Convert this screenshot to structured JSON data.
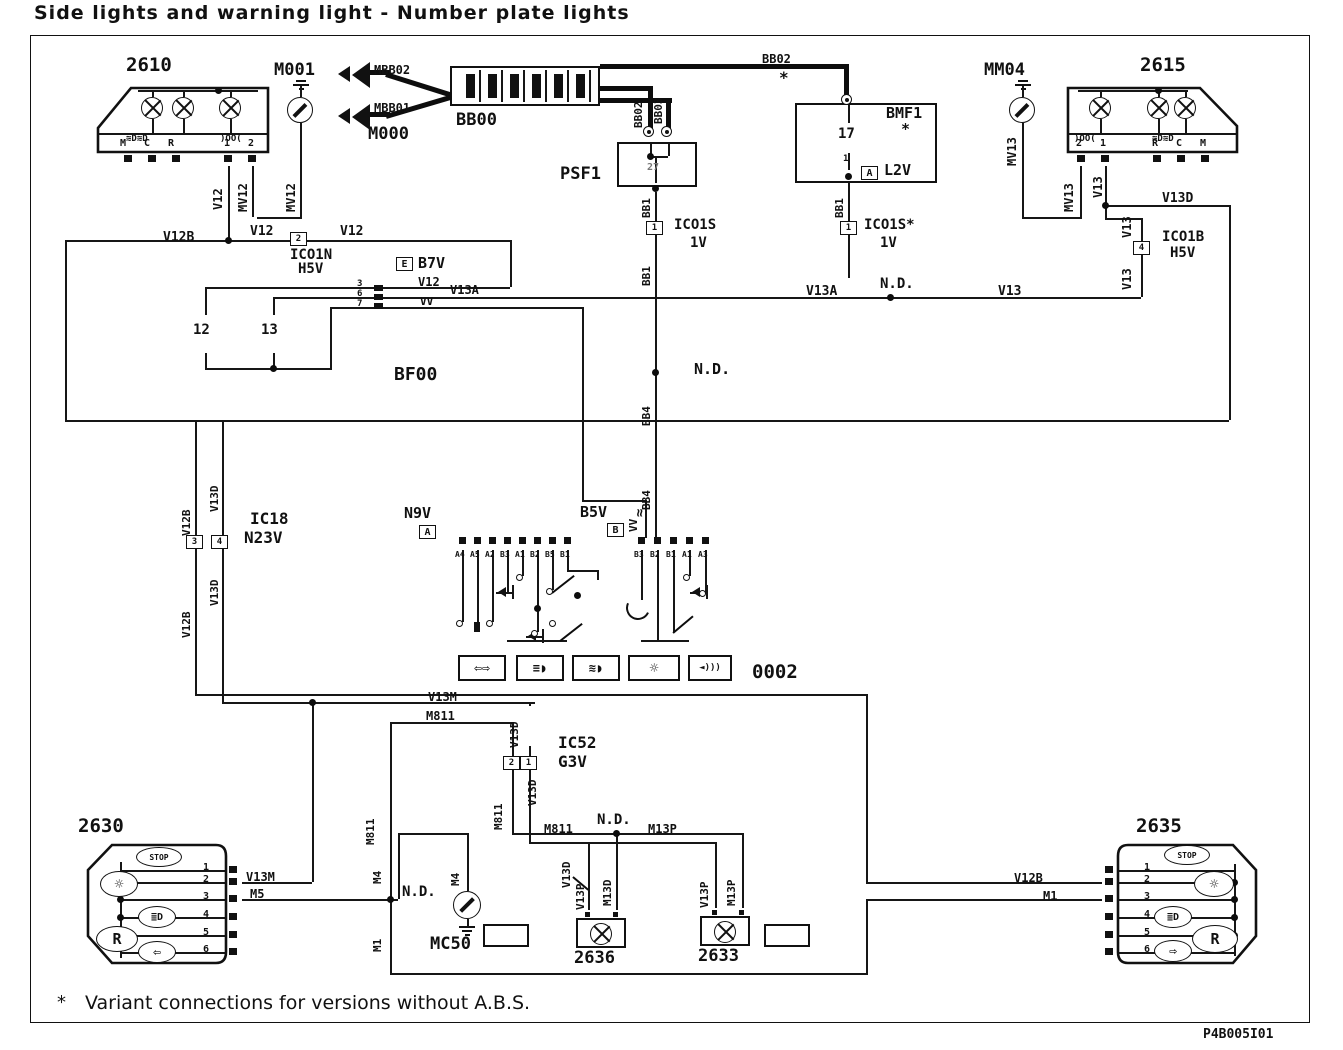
{
  "title": "Side lights and warning light - Number plate lights",
  "footnote": {
    "star": "*",
    "text": "Variant connections for versions without A.B.S."
  },
  "ref_code": "P4B005I01",
  "labels": [
    {
      "t": "2610",
      "x": 126,
      "y": 56,
      "s": 19,
      "n": "component-2610-label"
    },
    {
      "t": "M001",
      "x": 274,
      "y": 62,
      "s": 17,
      "n": "component-m001-label"
    },
    {
      "t": "MBB02",
      "x": 374,
      "y": 64,
      "s": 12,
      "n": "wire-label"
    },
    {
      "t": "MBB01",
      "x": 374,
      "y": 102,
      "s": 12,
      "n": "wire-label"
    },
    {
      "t": "M000",
      "x": 368,
      "y": 126,
      "s": 17,
      "n": "component-m000-label"
    },
    {
      "t": "BB00",
      "x": 456,
      "y": 112,
      "s": 17,
      "n": "component-bb00-label"
    },
    {
      "t": "PSF1",
      "x": 560,
      "y": 166,
      "s": 17,
      "n": "component-psf1-label"
    },
    {
      "t": "27",
      "x": 647,
      "y": 163,
      "s": 10,
      "n": "terminal-label",
      "c": "#777"
    },
    {
      "t": "BB02",
      "x": 762,
      "y": 53,
      "s": 12,
      "n": "wire-label"
    },
    {
      "t": "*",
      "x": 779,
      "y": 70,
      "s": 16,
      "n": "variant-star"
    },
    {
      "t": "BMF1",
      "x": 886,
      "y": 106,
      "s": 15,
      "n": "component-bmf1-label"
    },
    {
      "t": "*",
      "x": 901,
      "y": 122,
      "s": 15,
      "n": "variant-star"
    },
    {
      "t": "17",
      "x": 838,
      "y": 127,
      "s": 14,
      "n": "fuse-17-label"
    },
    {
      "t": "1",
      "x": 843,
      "y": 155,
      "s": 9,
      "n": "terminal-label"
    },
    {
      "t": "L2V",
      "x": 884,
      "y": 163,
      "s": 15,
      "n": "connector-l2v-label"
    },
    {
      "t": "MM04",
      "x": 984,
      "y": 62,
      "s": 17,
      "n": "component-mm04-label"
    },
    {
      "t": "2615",
      "x": 1140,
      "y": 56,
      "s": 19,
      "n": "component-2615-label"
    },
    {
      "t": "M",
      "x": 120,
      "y": 139,
      "s": 10,
      "n": "terminal-label"
    },
    {
      "t": "C",
      "x": 144,
      "y": 139,
      "s": 10,
      "n": "terminal-label"
    },
    {
      "t": "R",
      "x": 168,
      "y": 139,
      "s": 10,
      "n": "terminal-label"
    },
    {
      "t": "1",
      "x": 224,
      "y": 139,
      "s": 10,
      "n": "terminal-label"
    },
    {
      "t": "2",
      "x": 248,
      "y": 139,
      "s": 10,
      "n": "terminal-label"
    },
    {
      "t": "2",
      "x": 1076,
      "y": 139,
      "s": 10,
      "n": "terminal-label"
    },
    {
      "t": "1",
      "x": 1100,
      "y": 139,
      "s": 10,
      "n": "terminal-label"
    },
    {
      "t": "R",
      "x": 1152,
      "y": 139,
      "s": 10,
      "n": "terminal-label"
    },
    {
      "t": "C",
      "x": 1176,
      "y": 139,
      "s": 10,
      "n": "terminal-label"
    },
    {
      "t": "M",
      "x": 1200,
      "y": 139,
      "s": 10,
      "n": "terminal-label"
    },
    {
      "t": "≋D≋D",
      "x": 126,
      "y": 135,
      "s": 9,
      "n": "sidelight-icon"
    },
    {
      "t": ")OO(",
      "x": 220,
      "y": 135,
      "s": 9,
      "n": "position-light-icon"
    },
    {
      "t": ")OO(",
      "x": 1074,
      "y": 135,
      "s": 9,
      "n": "position-light-icon"
    },
    {
      "t": "≋D≋D",
      "x": 1152,
      "y": 135,
      "s": 9,
      "n": "sidelight-icon"
    },
    {
      "t": "V12",
      "x": 212,
      "y": 210,
      "s": 12,
      "r": 1,
      "n": "wire-label"
    },
    {
      "t": "MV12",
      "x": 237,
      "y": 212,
      "s": 12,
      "r": 1,
      "n": "wire-label"
    },
    {
      "t": "MV12",
      "x": 285,
      "y": 212,
      "s": 12,
      "r": 1,
      "n": "wire-label"
    },
    {
      "t": "BB02",
      "x": 633,
      "y": 128,
      "s": 11,
      "r": 1,
      "n": "wire-label"
    },
    {
      "t": "BB03",
      "x": 653,
      "y": 124,
      "s": 11,
      "r": 1,
      "n": "wire-label"
    },
    {
      "t": "BB1",
      "x": 641,
      "y": 218,
      "s": 11,
      "r": 1,
      "n": "wire-label"
    },
    {
      "t": "BB1",
      "x": 641,
      "y": 286,
      "s": 11,
      "r": 1,
      "n": "wire-label"
    },
    {
      "t": "BB1",
      "x": 834,
      "y": 218,
      "s": 11,
      "r": 1,
      "n": "wire-label"
    },
    {
      "t": "BB4",
      "x": 641,
      "y": 426,
      "s": 11,
      "r": 1,
      "n": "wire-label"
    },
    {
      "t": "BB4",
      "x": 641,
      "y": 510,
      "s": 11,
      "r": 1,
      "n": "wire-label"
    },
    {
      "t": "VV",
      "x": 628,
      "y": 532,
      "s": 11,
      "r": 1,
      "n": "wire-label"
    },
    {
      "t": "≈",
      "x": 633,
      "y": 517,
      "s": 14,
      "r": 1,
      "n": "resistive-wire-symbol"
    },
    {
      "t": "MV13",
      "x": 1006,
      "y": 166,
      "s": 12,
      "r": 1,
      "n": "wire-label"
    },
    {
      "t": "MV13",
      "x": 1063,
      "y": 212,
      "s": 12,
      "r": 1,
      "n": "wire-label"
    },
    {
      "t": "V13",
      "x": 1092,
      "y": 198,
      "s": 12,
      "r": 1,
      "n": "wire-label"
    },
    {
      "t": "V13",
      "x": 1121,
      "y": 238,
      "s": 12,
      "r": 1,
      "n": "wire-label"
    },
    {
      "t": "V13",
      "x": 1121,
      "y": 290,
      "s": 12,
      "r": 1,
      "n": "wire-label"
    },
    {
      "t": "V13D",
      "x": 1162,
      "y": 192,
      "s": 13,
      "n": "wire-label"
    },
    {
      "t": "ICO1S",
      "x": 674,
      "y": 218,
      "s": 14,
      "n": "connector-ic01s-label"
    },
    {
      "t": "1V",
      "x": 690,
      "y": 236,
      "s": 14,
      "n": "connector-ic01s-sub"
    },
    {
      "t": "ICO1S*",
      "x": 864,
      "y": 218,
      "s": 14,
      "n": "connector-ic01s-star-label"
    },
    {
      "t": "1V",
      "x": 880,
      "y": 236,
      "s": 14,
      "n": "connector-ic01s-star-sub"
    },
    {
      "t": "V12B",
      "x": 163,
      "y": 231,
      "s": 13,
      "n": "wire-label"
    },
    {
      "t": "V12",
      "x": 250,
      "y": 225,
      "s": 13,
      "n": "wire-label"
    },
    {
      "t": "V12",
      "x": 340,
      "y": 225,
      "s": 13,
      "n": "wire-label"
    },
    {
      "t": "ICO1N",
      "x": 290,
      "y": 248,
      "s": 14,
      "n": "connector-ic01n-label"
    },
    {
      "t": "H5V",
      "x": 298,
      "y": 262,
      "s": 14,
      "n": "connector-ic01n-sub"
    },
    {
      "t": "B7V",
      "x": 418,
      "y": 256,
      "s": 15,
      "n": "connector-b7v-label"
    },
    {
      "t": "ICO1B",
      "x": 1162,
      "y": 230,
      "s": 14,
      "n": "connector-ic01b-label"
    },
    {
      "t": "H5V",
      "x": 1170,
      "y": 246,
      "s": 14,
      "n": "connector-ic01b-sub"
    },
    {
      "t": "V12",
      "x": 418,
      "y": 276,
      "s": 12,
      "n": "wire-label"
    },
    {
      "t": "VV",
      "x": 420,
      "y": 296,
      "s": 11,
      "n": "wire-label"
    },
    {
      "t": "V13A",
      "x": 450,
      "y": 284,
      "s": 12,
      "n": "wire-label"
    },
    {
      "t": "V13A",
      "x": 806,
      "y": 285,
      "s": 13,
      "n": "wire-label"
    },
    {
      "t": "N.D.",
      "x": 880,
      "y": 277,
      "s": 14,
      "n": "nd-splice-label"
    },
    {
      "t": "V13",
      "x": 998,
      "y": 285,
      "s": 13,
      "n": "wire-label"
    },
    {
      "t": "12",
      "x": 193,
      "y": 323,
      "s": 14,
      "n": "fuse-12-label"
    },
    {
      "t": "13",
      "x": 261,
      "y": 323,
      "s": 14,
      "n": "fuse-13-label"
    },
    {
      "t": "3",
      "x": 357,
      "y": 280,
      "s": 9,
      "n": "terminal-label"
    },
    {
      "t": "6",
      "x": 357,
      "y": 290,
      "s": 9,
      "n": "terminal-label"
    },
    {
      "t": "7",
      "x": 357,
      "y": 300,
      "s": 9,
      "n": "terminal-label"
    },
    {
      "t": "BF00",
      "x": 394,
      "y": 366,
      "s": 18,
      "n": "component-bf00-label"
    },
    {
      "t": "N.D.",
      "x": 694,
      "y": 362,
      "s": 15,
      "n": "nd-splice-label"
    },
    {
      "t": "V13D",
      "x": 209,
      "y": 512,
      "s": 11,
      "r": 1,
      "n": "wire-label"
    },
    {
      "t": "V12B",
      "x": 181,
      "y": 536,
      "s": 11,
      "r": 1,
      "n": "wire-label"
    },
    {
      "t": "V13D",
      "x": 209,
      "y": 606,
      "s": 11,
      "r": 1,
      "n": "wire-label"
    },
    {
      "t": "V12B",
      "x": 181,
      "y": 638,
      "s": 11,
      "r": 1,
      "n": "wire-label"
    },
    {
      "t": "IC18",
      "x": 250,
      "y": 511,
      "s": 16,
      "n": "connector-ic18-label"
    },
    {
      "t": "N23V",
      "x": 244,
      "y": 530,
      "s": 16,
      "n": "connector-ic18-sub"
    },
    {
      "t": "N9V",
      "x": 404,
      "y": 506,
      "s": 15,
      "n": "connector-n9v-label"
    },
    {
      "t": "B5V",
      "x": 580,
      "y": 505,
      "s": 15,
      "n": "connector-b5v-label"
    },
    {
      "t": "A4",
      "x": 455,
      "y": 551,
      "s": 8,
      "n": "pin-label"
    },
    {
      "t": "A5",
      "x": 470,
      "y": 551,
      "s": 8,
      "n": "pin-label"
    },
    {
      "t": "A2",
      "x": 485,
      "y": 551,
      "s": 8,
      "n": "pin-label"
    },
    {
      "t": "B3",
      "x": 500,
      "y": 551,
      "s": 8,
      "n": "pin-label"
    },
    {
      "t": "A1",
      "x": 515,
      "y": 551,
      "s": 8,
      "n": "pin-label"
    },
    {
      "t": "B2",
      "x": 530,
      "y": 551,
      "s": 8,
      "n": "pin-label"
    },
    {
      "t": "B5",
      "x": 545,
      "y": 551,
      "s": 8,
      "n": "pin-label"
    },
    {
      "t": "B1",
      "x": 560,
      "y": 551,
      "s": 8,
      "n": "pin-label"
    },
    {
      "t": "B3",
      "x": 634,
      "y": 551,
      "s": 8,
      "n": "pin-label"
    },
    {
      "t": "B2",
      "x": 650,
      "y": 551,
      "s": 8,
      "n": "pin-label"
    },
    {
      "t": "B1",
      "x": 666,
      "y": 551,
      "s": 8,
      "n": "pin-label"
    },
    {
      "t": "A1",
      "x": 682,
      "y": 551,
      "s": 8,
      "n": "pin-label"
    },
    {
      "t": "A3",
      "x": 698,
      "y": 551,
      "s": 8,
      "n": "pin-label"
    },
    {
      "t": "0002",
      "x": 752,
      "y": 663,
      "s": 19,
      "n": "component-0002-label"
    },
    {
      "t": "V13M",
      "x": 428,
      "y": 691,
      "s": 12,
      "n": "wire-label"
    },
    {
      "t": "M811",
      "x": 426,
      "y": 710,
      "s": 12,
      "n": "wire-label"
    },
    {
      "t": "V13D",
      "x": 509,
      "y": 748,
      "s": 11,
      "r": 1,
      "n": "wire-label"
    },
    {
      "t": "IC52",
      "x": 558,
      "y": 735,
      "s": 16,
      "n": "connector-ic52-label"
    },
    {
      "t": "G3V",
      "x": 558,
      "y": 754,
      "s": 16,
      "n": "connector-ic52-sub"
    },
    {
      "t": "V13D",
      "x": 527,
      "y": 806,
      "s": 11,
      "r": 1,
      "n": "wire-label"
    },
    {
      "t": "M811",
      "x": 493,
      "y": 830,
      "s": 11,
      "r": 1,
      "n": "wire-label"
    },
    {
      "t": "M811",
      "x": 365,
      "y": 845,
      "s": 11,
      "r": 1,
      "n": "wire-label"
    },
    {
      "t": "M811",
      "x": 544,
      "y": 823,
      "s": 12,
      "n": "wire-label"
    },
    {
      "t": "N.D.",
      "x": 597,
      "y": 813,
      "s": 14,
      "n": "nd-splice-label"
    },
    {
      "t": "M13P",
      "x": 648,
      "y": 823,
      "s": 12,
      "n": "wire-label"
    },
    {
      "t": "2630",
      "x": 78,
      "y": 817,
      "s": 19,
      "n": "component-2630-label"
    },
    {
      "t": "1",
      "x": 203,
      "y": 863,
      "s": 10,
      "n": "terminal-label"
    },
    {
      "t": "2",
      "x": 203,
      "y": 875,
      "s": 10,
      "n": "terminal-label"
    },
    {
      "t": "3",
      "x": 203,
      "y": 892,
      "s": 10,
      "n": "terminal-label"
    },
    {
      "t": "4",
      "x": 203,
      "y": 910,
      "s": 10,
      "n": "terminal-label"
    },
    {
      "t": "5",
      "x": 203,
      "y": 928,
      "s": 10,
      "n": "terminal-label"
    },
    {
      "t": "6",
      "x": 203,
      "y": 945,
      "s": 10,
      "n": "terminal-label"
    },
    {
      "t": "V13M",
      "x": 246,
      "y": 871,
      "s": 12,
      "n": "wire-label"
    },
    {
      "t": "M5",
      "x": 250,
      "y": 888,
      "s": 12,
      "n": "wire-label"
    },
    {
      "t": "M4",
      "x": 372,
      "y": 884,
      "s": 11,
      "r": 1,
      "n": "wire-label"
    },
    {
      "t": "M4",
      "x": 450,
      "y": 886,
      "s": 11,
      "r": 1,
      "n": "wire-label"
    },
    {
      "t": "N.D.",
      "x": 402,
      "y": 885,
      "s": 14,
      "n": "nd-splice-label"
    },
    {
      "t": "M1",
      "x": 372,
      "y": 952,
      "s": 11,
      "r": 1,
      "n": "wire-label"
    },
    {
      "t": "MC50",
      "x": 430,
      "y": 936,
      "s": 17,
      "n": "component-mc50-label"
    },
    {
      "t": "V13D",
      "x": 561,
      "y": 888,
      "s": 11,
      "r": 1,
      "n": "wire-label"
    },
    {
      "t": "V13P",
      "x": 575,
      "y": 910,
      "s": 11,
      "r": 1,
      "n": "wire-label"
    },
    {
      "t": "M13D",
      "x": 602,
      "y": 906,
      "s": 11,
      "r": 1,
      "n": "wire-label"
    },
    {
      "t": "V13P",
      "x": 699,
      "y": 908,
      "s": 11,
      "r": 1,
      "n": "wire-label"
    },
    {
      "t": "M13P",
      "x": 726,
      "y": 906,
      "s": 11,
      "r": 1,
      "n": "wire-label"
    },
    {
      "t": "2636",
      "x": 574,
      "y": 950,
      "s": 17,
      "n": "component-2636-label"
    },
    {
      "t": "2633",
      "x": 698,
      "y": 948,
      "s": 17,
      "n": "component-2633-label"
    },
    {
      "t": "2635",
      "x": 1136,
      "y": 817,
      "s": 19,
      "n": "component-2635-label"
    },
    {
      "t": "1",
      "x": 1144,
      "y": 863,
      "s": 10,
      "n": "terminal-label"
    },
    {
      "t": "2",
      "x": 1144,
      "y": 875,
      "s": 10,
      "n": "terminal-label"
    },
    {
      "t": "3",
      "x": 1144,
      "y": 892,
      "s": 10,
      "n": "terminal-label"
    },
    {
      "t": "4",
      "x": 1144,
      "y": 910,
      "s": 10,
      "n": "terminal-label"
    },
    {
      "t": "5",
      "x": 1144,
      "y": 928,
      "s": 10,
      "n": "terminal-label"
    },
    {
      "t": "6",
      "x": 1144,
      "y": 945,
      "s": 10,
      "n": "terminal-label"
    },
    {
      "t": "V12B",
      "x": 1014,
      "y": 872,
      "s": 12,
      "n": "wire-label"
    },
    {
      "t": "M1",
      "x": 1043,
      "y": 890,
      "s": 12,
      "n": "wire-label"
    },
    {
      "t": "2",
      "x": 290,
      "y": 232,
      "cell": 1,
      "s": 9,
      "n": "connector-pin-cell"
    },
    {
      "t": "1",
      "x": 646,
      "y": 221,
      "cell": 1,
      "s": 9,
      "n": "connector-pin-cell"
    },
    {
      "t": "1",
      "x": 840,
      "y": 221,
      "cell": 1,
      "s": 9,
      "n": "connector-pin-cell"
    },
    {
      "t": "4",
      "x": 1133,
      "y": 241,
      "cell": 1,
      "s": 9,
      "n": "connector-pin-cell"
    },
    {
      "t": "3",
      "x": 186,
      "y": 535,
      "cell": 1,
      "s": 9,
      "n": "connector-pin-cell"
    },
    {
      "t": "4",
      "x": 211,
      "y": 535,
      "cell": 1,
      "s": 9,
      "n": "connector-pin-cell"
    },
    {
      "t": "2",
      "x": 503,
      "y": 756,
      "cell": 1,
      "s": 9,
      "n": "connector-pin-cell"
    },
    {
      "t": "1",
      "x": 520,
      "y": 756,
      "cell": 1,
      "s": 9,
      "n": "connector-pin-cell"
    },
    {
      "t": "E",
      "x": 396,
      "y": 257,
      "cell": 1,
      "s": 10,
      "n": "harness-code-e"
    },
    {
      "t": "A",
      "x": 419,
      "y": 525,
      "cell": 1,
      "s": 10,
      "n": "harness-code-a"
    },
    {
      "t": "B",
      "x": 607,
      "y": 523,
      "cell": 1,
      "s": 10,
      "n": "harness-code-b"
    },
    {
      "t": "A",
      "x": 861,
      "y": 166,
      "cell": 1,
      "s": 10,
      "n": "harness-code-a"
    },
    {
      "t": "STOP",
      "x": 136,
      "y": 847,
      "sym": [
        46,
        20
      ],
      "s": 8,
      "n": "stop-lamp-icon"
    },
    {
      "t": "☼",
      "x": 100,
      "y": 871,
      "sym": [
        38,
        26
      ],
      "s": 15,
      "n": "warning-bulb-icon"
    },
    {
      "t": "≣D",
      "x": 138,
      "y": 906,
      "sym": [
        38,
        22
      ],
      "s": 10,
      "n": "fog-lamp-icon"
    },
    {
      "t": "R",
      "x": 96,
      "y": 926,
      "sym": [
        42,
        26
      ],
      "s": 15,
      "n": "reverse-lamp-icon"
    },
    {
      "t": "⇦",
      "x": 138,
      "y": 941,
      "sym": [
        38,
        22
      ],
      "s": 13,
      "n": "turn-signal-icon"
    },
    {
      "t": "STOP",
      "x": 1164,
      "y": 845,
      "sym": [
        46,
        20
      ],
      "s": 8,
      "n": "stop-lamp-icon"
    },
    {
      "t": "☼",
      "x": 1194,
      "y": 871,
      "sym": [
        40,
        26
      ],
      "s": 15,
      "n": "warning-bulb-icon"
    },
    {
      "t": "≣D",
      "x": 1154,
      "y": 906,
      "sym": [
        38,
        22
      ],
      "s": 10,
      "n": "fog-lamp-icon"
    },
    {
      "t": "R",
      "x": 1192,
      "y": 925,
      "sym": [
        46,
        28
      ],
      "s": 15,
      "n": "reverse-lamp-icon"
    },
    {
      "t": "⇨",
      "x": 1154,
      "y": 940,
      "sym": [
        38,
        22
      ],
      "s": 13,
      "n": "turn-signal-icon"
    },
    {
      "t": "⇦⇨",
      "x": 458,
      "y": 655,
      "ibox": [
        48,
        26
      ],
      "s": 13,
      "n": "turn-signal-switch-icon"
    },
    {
      "t": "≡◗",
      "x": 516,
      "y": 655,
      "ibox": [
        48,
        26
      ],
      "s": 12,
      "n": "dipped-beam-icon"
    },
    {
      "t": "≋◗",
      "x": 572,
      "y": 655,
      "ibox": [
        48,
        26
      ],
      "s": 12,
      "n": "main-beam-icon"
    },
    {
      "t": "☼",
      "x": 628,
      "y": 655,
      "ibox": [
        52,
        26
      ],
      "s": 15,
      "n": "lighting-switch-icon"
    },
    {
      "t": "◄)))",
      "x": 688,
      "y": 655,
      "ibox": [
        44,
        26
      ],
      "s": 9,
      "n": "horn-icon"
    }
  ]
}
